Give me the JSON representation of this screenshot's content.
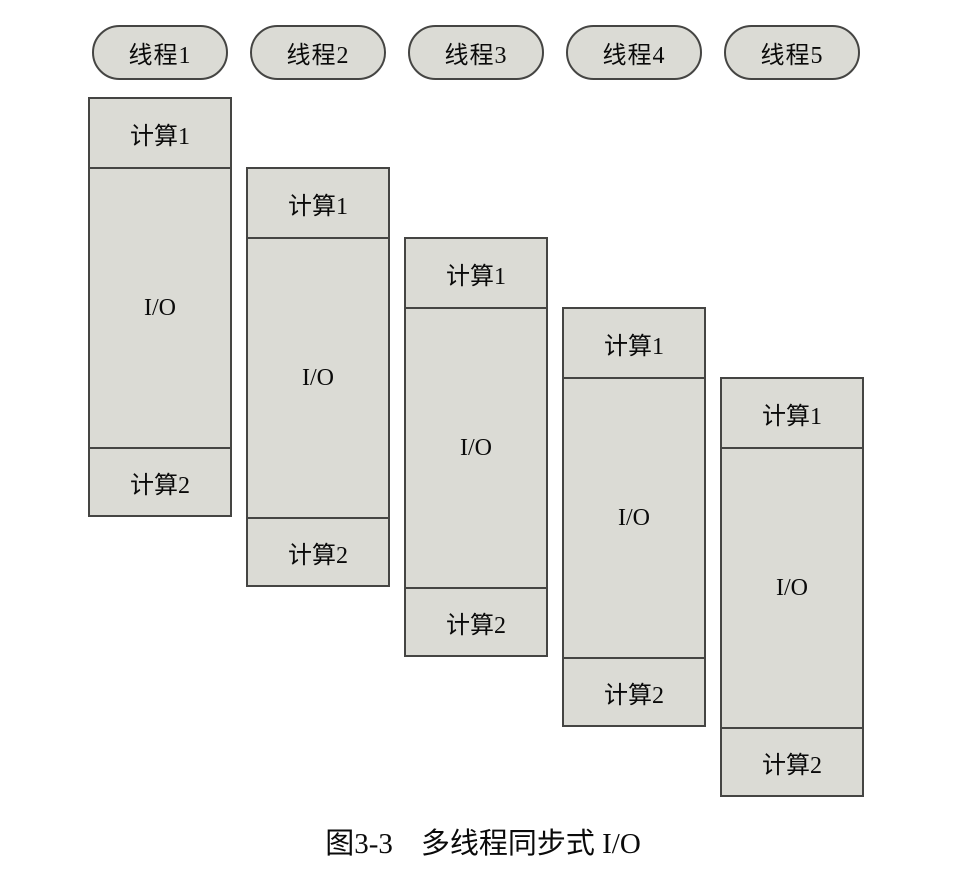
{
  "figure": {
    "caption_number": "图3-3",
    "caption_title": "多线程同步式 I/O"
  },
  "colors": {
    "box_fill": "#dbdbd5",
    "box_border": "#454543",
    "text": "#0a0a0a",
    "background": "#ffffff"
  },
  "threads": [
    {
      "label": "线程1",
      "segments": [
        "计算1",
        "I/O",
        "计算2"
      ]
    },
    {
      "label": "线程2",
      "segments": [
        "计算1",
        "I/O",
        "计算2"
      ]
    },
    {
      "label": "线程3",
      "segments": [
        "计算1",
        "I/O",
        "计算2"
      ]
    },
    {
      "label": "线程4",
      "segments": [
        "计算1",
        "I/O",
        "计算2"
      ]
    },
    {
      "label": "线程5",
      "segments": [
        "计算1",
        "I/O",
        "计算2"
      ]
    }
  ]
}
